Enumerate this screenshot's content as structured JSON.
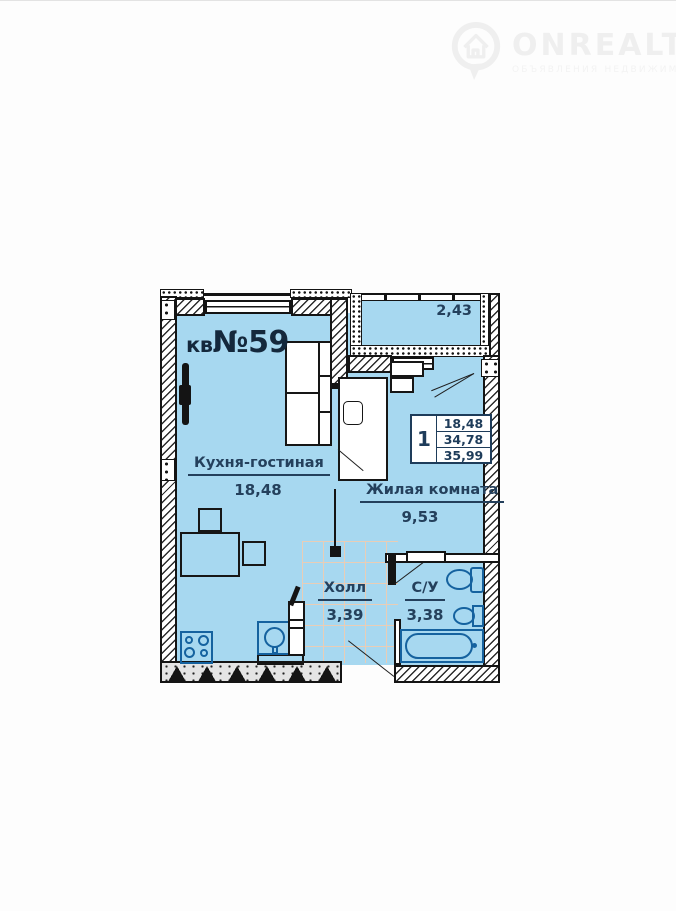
{
  "watermark": {
    "brand": "ONREALT",
    "tagline": "ОБЪЯВЛЕНИЯ НЕДВИЖИМОСТИ",
    "icon": "house-pin-icon",
    "text_color": "#efefef"
  },
  "plan": {
    "apartment_label_prefix": "кв",
    "apartment_number": "№59",
    "kitchen": {
      "name": "Кухня-гостиная",
      "area": "18,48"
    },
    "living": {
      "name": "Жилая комната",
      "area": "9,53"
    },
    "hall": {
      "name": "Холл",
      "area": "3,39"
    },
    "bathroom": {
      "name": "С/У",
      "area": "3,38"
    },
    "balcony": {
      "area": "2,43"
    },
    "info_table": {
      "rooms_count": "1",
      "living_area": "18,48",
      "apartment_area": "34,78",
      "total_area": "35,99"
    },
    "colors": {
      "floor": "#a7d8f0",
      "wall": "#141414",
      "fixture_outline": "#15629f",
      "label_text": "#24405c",
      "tile_grid": "#e9cdb6"
    }
  }
}
